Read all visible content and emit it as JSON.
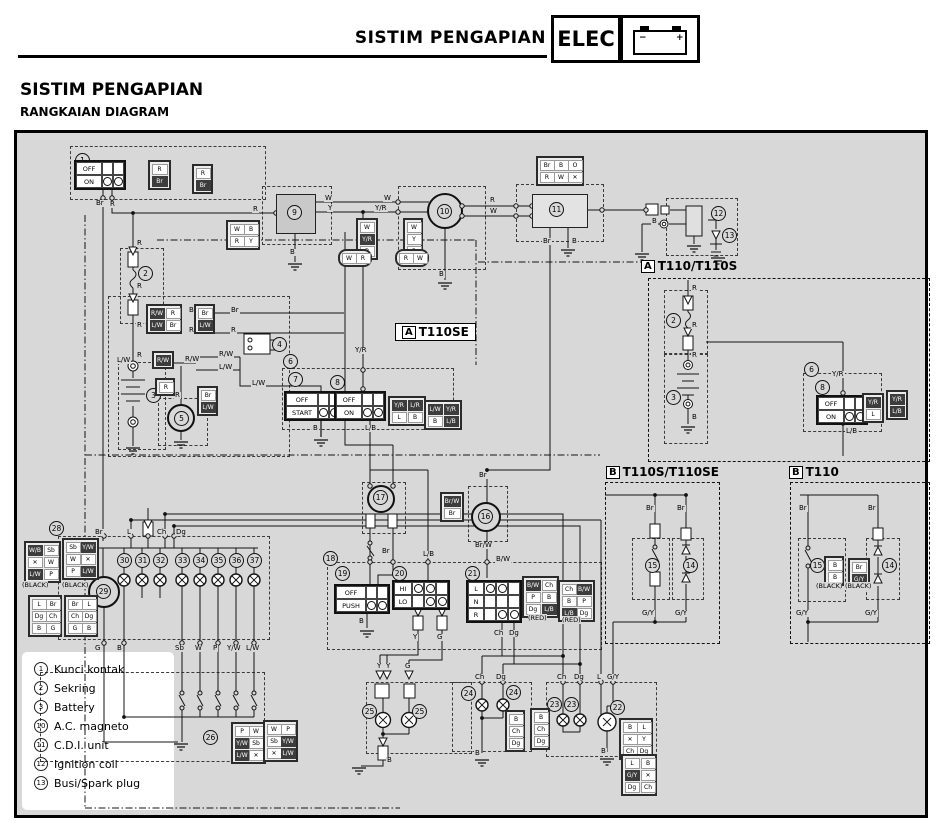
{
  "header": {
    "running_title": "SISTIM PENGAPIAN",
    "elec_label": "ELEC",
    "battery_minus": "−",
    "battery_plus": "+"
  },
  "page": {
    "title": "SISTIM PENGAPIAN",
    "subtitle": "RANGKAIAN DIAGRAM"
  },
  "sections": {
    "t110se": {
      "tag": "A",
      "name": "T110SE"
    },
    "t110_t110s": {
      "tag": "A",
      "name": "T110/T110S"
    },
    "t110s_t110se": {
      "tag": "B",
      "name": "T110S/T110SE"
    },
    "t110": {
      "tag": "B",
      "name": "T110"
    }
  },
  "legend": {
    "items": [
      {
        "num": "1",
        "label": "Kunci kontak"
      },
      {
        "num": "2",
        "label": "Sekring"
      },
      {
        "num": "3",
        "label": "Battery"
      },
      {
        "num": "10",
        "label": "A.C. magneto"
      },
      {
        "num": "11",
        "label": "C.D.I. unit"
      },
      {
        "num": "12",
        "label": "Ignition coil"
      },
      {
        "num": "13",
        "label": "Busi/Spark plug"
      }
    ]
  },
  "markers": {
    "black": "(BLACK)",
    "red": "(RED)"
  },
  "switches": {
    "s1": {
      "rows": [
        "OFF",
        "ON"
      ]
    },
    "s7": {
      "rows": [
        "OFF",
        "START"
      ]
    },
    "s8": {
      "rows": [
        "OFF",
        "ON"
      ]
    },
    "s19": {
      "rows": [
        "OFF",
        "PUSH"
      ]
    },
    "s20": {
      "rows": [
        "HI",
        "LO"
      ]
    },
    "s21": {
      "rows": [
        "L",
        "N",
        "R"
      ]
    }
  },
  "nums": {
    "1": "1",
    "2": "2",
    "3": "3",
    "4": "4",
    "5": "5",
    "6": "6",
    "7": "7",
    "8": "8",
    "9": "9",
    "10": "10",
    "11": "11",
    "12": "12",
    "13": "13",
    "14": "14",
    "15": "15",
    "16": "16",
    "17": "17",
    "18": "18",
    "19": "19",
    "20": "20",
    "21": "21",
    "22": "22",
    "23": "23",
    "24": "24",
    "25": "25",
    "26": "26",
    "28": "28",
    "29": "29",
    "30": "30",
    "31": "31",
    "32": "32",
    "33": "33",
    "34": "34",
    "35": "35",
    "36": "36",
    "37": "37"
  },
  "wire": {
    "b": "B",
    "br": "Br",
    "r": "R",
    "w": "W",
    "y": "Y",
    "g": "G",
    "l": "L",
    "o": "O",
    "p": "P",
    "x": "✕",
    "ch": "Ch",
    "dg": "Dg",
    "sb": "Sb",
    "yr": "Y/R",
    "lb": "L/B",
    "lw": "L/W",
    "lr": "L/R",
    "rw": "R/W",
    "gy": "G/Y",
    "yw": "Y/W",
    "bw": "B/W",
    "brw": "Br/W",
    "wb": "W/B"
  }
}
